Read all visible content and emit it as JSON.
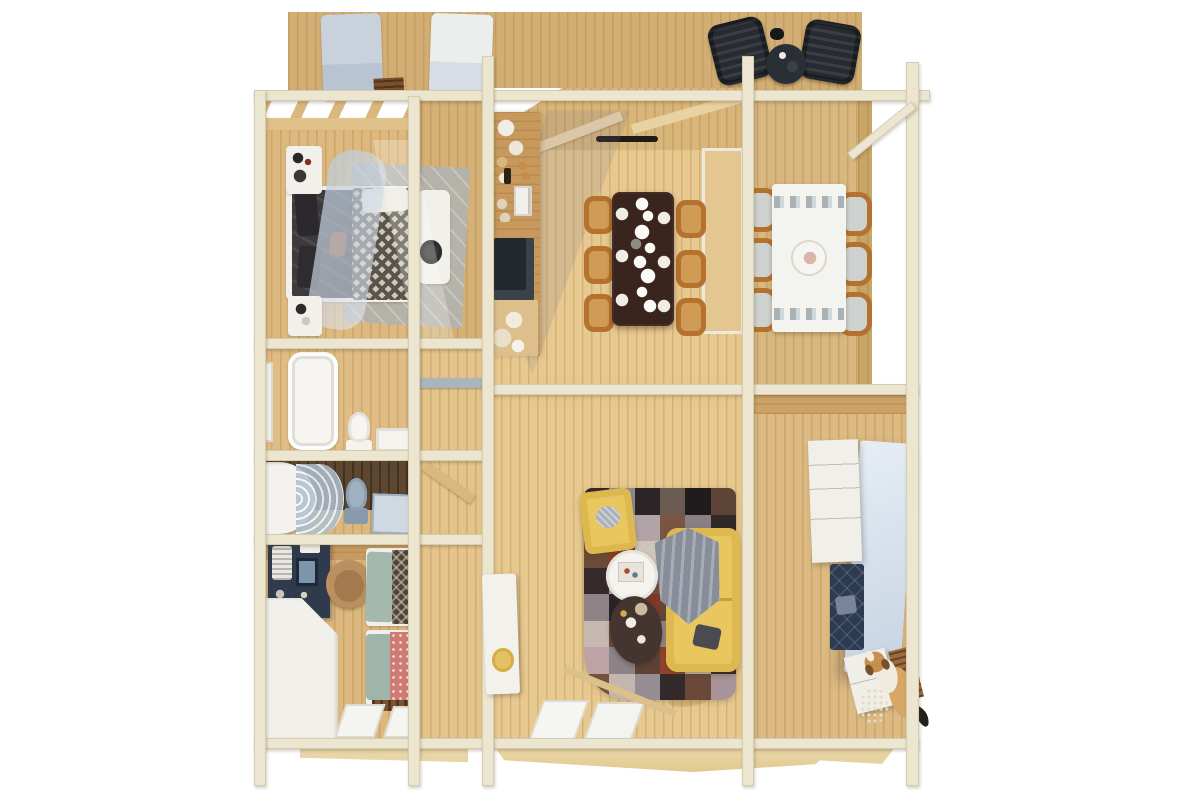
{
  "scene": {
    "type": "3d-log-cabin-floorplan-top-view",
    "rooms": [
      {
        "name": "back-deck",
        "items": [
          "lounger",
          "lounger",
          "wooden-crate",
          "lounge-chair",
          "lounge-chair",
          "patio-table",
          "kettle"
        ]
      },
      {
        "name": "master-bedroom",
        "items": [
          "double-bed",
          "dark-duvet",
          "patterned-throw",
          "sheer-canopy",
          "gray-rug",
          "dresser",
          "nightstand",
          "bench",
          "hat"
        ]
      },
      {
        "name": "bathroom",
        "items": [
          "bathtub",
          "toilet",
          "sink",
          "window"
        ]
      },
      {
        "name": "shower-room",
        "items": [
          "curved-shower",
          "toilet",
          "vanity-sink"
        ]
      },
      {
        "name": "kids-bedroom",
        "items": [
          "vanity-desk",
          "mirror",
          "round-chair",
          "wardrobe",
          "single-bed-dark",
          "single-bed-pink",
          "doormat",
          "windows"
        ]
      },
      {
        "name": "hallway",
        "items": [
          "open-door",
          "white-door-with-mirror"
        ]
      },
      {
        "name": "kitchen-dining",
        "items": [
          "kitchen-counter",
          "coffee-machine",
          "cooktop",
          "dining-table",
          "six-chairs",
          "pendant-lights",
          "plates",
          "door-handle",
          "glass-door"
        ]
      },
      {
        "name": "living-room",
        "items": [
          "patchwork-rug",
          "yellow-sofa",
          "gray-blanket",
          "yellow-armchair",
          "round-white-table",
          "dark-oval-table",
          "front-glass-doors"
        ]
      },
      {
        "name": "side-terrace",
        "items": [
          "white-dining-table",
          "six-terrace-chairs",
          "pergola-posts",
          "diagonal-brace"
        ]
      },
      {
        "name": "entry-room",
        "items": [
          "white-drawer-cabinet",
          "tall-blue-cabinet",
          "navy-quilted-bench",
          "white-nightstand",
          "wooden-crate",
          "dried-flowers",
          "dog"
        ]
      }
    ],
    "colors": {
      "background": "#ffffff",
      "wood-back": "#d2ae74",
      "wood-wall": "#d5b176",
      "wood-floor": "#e7c98f",
      "wood-floor-left": "#ddb97f",
      "wood-hall": "#e4c48a",
      "wood-deck": "#d8b87f",
      "wood-band": "#d8b578",
      "beam": "#ece6d0",
      "beam-edge": "#d5cdb2",
      "dark-wall": "#5d4730",
      "white-soft": "#f2f0ea",
      "sofa-yellow": "#e9c75e",
      "chair-frame": "#b5722f",
      "chair-seat": "#cf9b55",
      "cushion-gray": "#cdd2cf",
      "table-dark": "#3a241e",
      "bed-dark": "#3c3a3d",
      "canopy": "#bccbdb",
      "rug-gray": "#b5b2aa",
      "teal": "#a4b8ae",
      "pink-duvet": "#cd7b74",
      "navy": "#2c3a52",
      "vanity-navy": "#2f3b4d",
      "glass-blue": "#aebfd0",
      "blue-cabinet": "#d7e2ee",
      "deckchair-dark": "#262b31",
      "shadow": "rgba(120,114,148,0.16)",
      "dog-tan": "#d7a766",
      "skirt": "#e9d6a8"
    },
    "rug_rows": [
      [
        "#33282a",
        "#8e8a8f",
        "#2c2426",
        "#6b5a52",
        "#201c1d",
        "#5d4436"
      ],
      [
        "#a68e92",
        "#c7bbb3",
        "#b2a3a6",
        "#7a5544",
        "#898085",
        "#31282a"
      ],
      [
        "#6b4a38",
        "#8f3c22",
        "#cfc5bc",
        "#2e2527",
        "#9b898d",
        "#7d6a62"
      ],
      [
        "#36292b",
        "#c0a6aa",
        "#714e3e",
        "#938b8f",
        "#c9beb5",
        "#463937"
      ],
      [
        "#8e8488",
        "#2a2224",
        "#7e3a26",
        "#654839",
        "#b7999d",
        "#82797f"
      ],
      [
        "#c4b8b0",
        "#6e4c3c",
        "#2f2527",
        "#a08c90",
        "#3a2e30",
        "#856151"
      ],
      [
        "#bda2a6",
        "#8c8288",
        "#5e4235",
        "#92432b",
        "#cbc0b8",
        "#2e2628"
      ],
      [
        "#73513e",
        "#c2b6ae",
        "#958d91",
        "#33292b",
        "#6a493a",
        "#a79399"
      ]
    ]
  }
}
